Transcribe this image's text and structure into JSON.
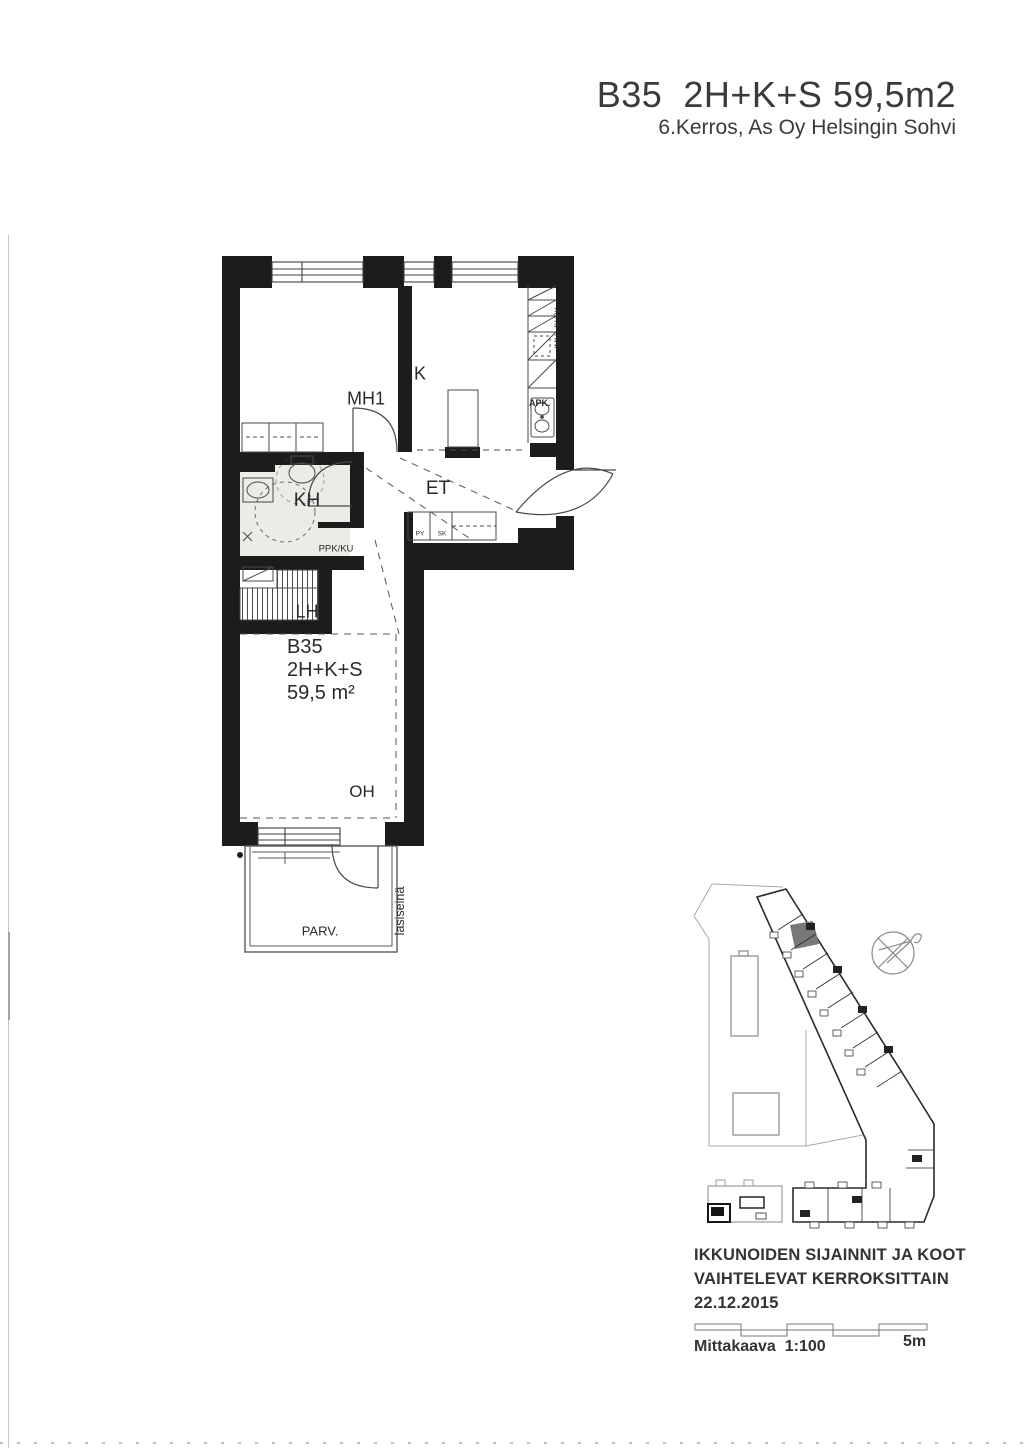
{
  "title": {
    "main": "B35  2H+K+S 59,5m2",
    "subtitle": "6.Kerros, As Oy Helsingin Sohvi"
  },
  "floor_plan": {
    "rooms": {
      "mh1": "MH1",
      "k": "K",
      "kh": "KH",
      "et": "ET",
      "lh": "LH",
      "oh": "OH",
      "parv": "PARV."
    },
    "unit": {
      "id": "B35",
      "type": "2H+K+S",
      "area": "59,5 m²"
    },
    "fixtures": {
      "ppk_ku": "PPK/KU",
      "apk": "APK.",
      "jk_pk": "(MU) JK/PK",
      "py": "PY",
      "sk": "SK",
      "lasiseina": "lasiseinä"
    }
  },
  "site_plan": {
    "note_line1": "IKKUNOIDEN SIJAINNIT JA KOOT",
    "note_line2": "VAIHTELEVAT KERROKSITTAIN",
    "note_date": "22.12.2015",
    "compass_icon": "compass-north-arrow"
  },
  "scale_bar": {
    "label": "Mittakaava  1:100",
    "right_label": "5m"
  },
  "colors": {
    "wall": "#1c1c1a",
    "line": "#3f3f3f",
    "light_line": "#8a8a8a",
    "highlight": "#787878",
    "kh_floor": "#ebebe8"
  }
}
